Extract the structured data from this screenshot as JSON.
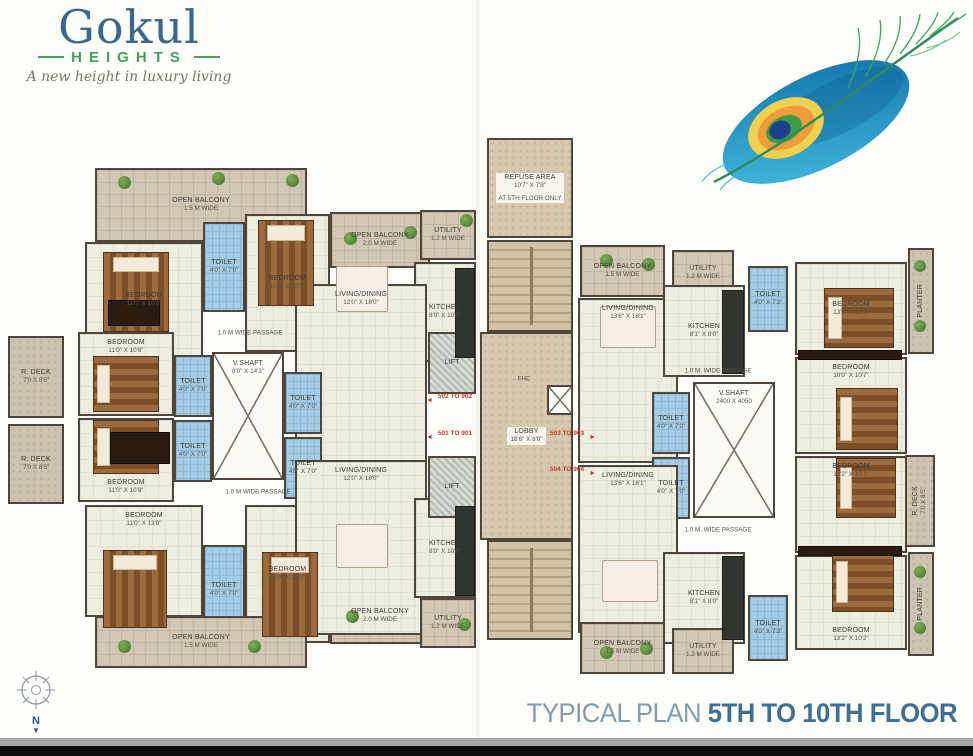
{
  "brand": {
    "name": "Gokul",
    "sub": "HEIGHTS",
    "tagline": "A new height in luxury living"
  },
  "footer": {
    "title_regular": "TYPICAL PLAN",
    "title_bold": "5TH TO 10TH FLOOR"
  },
  "compass": {
    "north": "N",
    "arrow": "▼"
  },
  "colors": {
    "brand_blue": "#39688f",
    "brand_green": "#43a05f",
    "title_light": "#7f9cb0",
    "title_dark": "#3e6f95",
    "flat_number_red": "#c23b33",
    "wall": "#4e453c",
    "floor": "#edeee0",
    "balcony": "#d2c6b4",
    "toilet_blue": "#a5cce4",
    "stair_tan": "#d3c3a6",
    "feather_blue": "#0f6da6",
    "feather_cyan": "#45bfe0",
    "feather_yellow": "#f0d14d",
    "feather_orange": "#ee9d3a",
    "feather_green": "#3f9b45",
    "feather_navy": "#1c3f8e"
  },
  "plan": {
    "rooms": [
      {
        "type": "balcony",
        "label": "OPEN BALCONY",
        "dims": "1.5 M WIDE",
        "x": 95,
        "y": 168,
        "w": 212,
        "h": 74
      },
      {
        "type": "floor",
        "label": "BEDROOM",
        "dims": "11'0\" X 10'0\"",
        "x": 85,
        "y": 242,
        "w": 118,
        "h": 116
      },
      {
        "type": "toilet",
        "label": "TOILET",
        "dims": "4'0\" X 7'0\"",
        "x": 203,
        "y": 222,
        "w": 42,
        "h": 90
      },
      {
        "type": "floor",
        "label": "BEDROOM",
        "dims": "10'0\" X 12'0\"",
        "x": 245,
        "y": 214,
        "w": 85,
        "h": 138
      },
      {
        "type": "balcony",
        "label": "OPEN BALCONY",
        "dims": "2.0 M WIDE",
        "x": 330,
        "y": 212,
        "w": 100,
        "h": 56
      },
      {
        "type": "balcony",
        "label": "UTILITY",
        "dims": "1.2 M WIDE",
        "x": 420,
        "y": 210,
        "w": 56,
        "h": 50
      },
      {
        "type": "floor",
        "label": "KITCHEN",
        "dims": "8'0\" X 10'0\"",
        "x": 414,
        "y": 262,
        "w": 62,
        "h": 100
      },
      {
        "type": "floor",
        "label": "LIVING/DINING",
        "dims": "12'0\" X 18'0\"",
        "x": 295,
        "y": 284,
        "w": 132,
        "h": 180,
        "la": "t"
      },
      {
        "type": "shaft",
        "label": "V.SHAFT",
        "dims": "8'0\" X 14'3\"",
        "x": 212,
        "y": 352,
        "w": 72,
        "h": 128,
        "la": "t"
      },
      {
        "type": "toilet",
        "label": "TOILET",
        "dims": "4'0\" X 7'0\"",
        "x": 174,
        "y": 355,
        "w": 38,
        "h": 62
      },
      {
        "type": "toilet",
        "label": "TOILET",
        "dims": "4'0\" X 7'0\"",
        "x": 174,
        "y": 420,
        "w": 38,
        "h": 62
      },
      {
        "type": "toilet",
        "label": "TOILET",
        "dims": "4'0\" X 7'0\"",
        "x": 284,
        "y": 372,
        "w": 38,
        "h": 62
      },
      {
        "type": "toilet",
        "label": "TOILET",
        "dims": "4'0\" X 7'0\"",
        "x": 284,
        "y": 437,
        "w": 38,
        "h": 62
      },
      {
        "type": "floor",
        "label": "BEDROOM",
        "dims": "11'0\" X 10'8\"",
        "x": 78,
        "y": 332,
        "w": 96,
        "h": 84,
        "la": "t"
      },
      {
        "type": "floor",
        "label": "BEDROOM",
        "dims": "11'0\" X 10'8\"",
        "x": 78,
        "y": 418,
        "w": 96,
        "h": 84,
        "la": "b"
      },
      {
        "type": "deck",
        "label": "R. DECK",
        "dims": "7'0 X 8'5\"",
        "x": 8,
        "y": 336,
        "w": 56,
        "h": 82
      },
      {
        "type": "deck",
        "label": "R. DECK",
        "dims": "7'0 X 8'5\"",
        "x": 8,
        "y": 424,
        "w": 56,
        "h": 80
      },
      {
        "type": "floor",
        "label": "BEDROOM",
        "dims": "11'0\" X 13'0\"",
        "x": 85,
        "y": 505,
        "w": 118,
        "h": 112,
        "la": "t"
      },
      {
        "type": "toilet",
        "label": "TOILET",
        "dims": "4'0\" X 7'0\"",
        "x": 203,
        "y": 545,
        "w": 42,
        "h": 90
      },
      {
        "type": "floor",
        "label": "BEDROOM",
        "dims": "10'0\" X 13'0\"",
        "x": 245,
        "y": 505,
        "w": 85,
        "h": 138
      },
      {
        "type": "balcony",
        "label": "OPEN BALCONY",
        "dims": "2.0 M WIDE",
        "x": 330,
        "y": 588,
        "w": 100,
        "h": 56
      },
      {
        "type": "floor",
        "label": "LIVING/DINING",
        "dims": "12'0\" X 18'0\"",
        "x": 295,
        "y": 460,
        "w": 132,
        "h": 175,
        "la": "t"
      },
      {
        "type": "floor",
        "label": "KITCHEN",
        "dims": "8'0\" X 10'0\"",
        "x": 414,
        "y": 498,
        "w": 62,
        "h": 100
      },
      {
        "type": "balcony",
        "label": "UTILITY",
        "dims": "1.2 M WIDE",
        "x": 420,
        "y": 598,
        "w": 56,
        "h": 50
      },
      {
        "type": "balcony",
        "label": "OPEN BALCONY",
        "dims": "1.5 M WIDE",
        "x": 95,
        "y": 616,
        "w": 212,
        "h": 52
      },
      {
        "type": "lift",
        "label": "LIFT",
        "x": 428,
        "y": 332,
        "w": 48,
        "h": 62
      },
      {
        "type": "lift",
        "label": "LIFT",
        "x": 428,
        "y": 456,
        "w": 48,
        "h": 62
      },
      {
        "type": "lobbytex",
        "label": "REFUSE AREA",
        "dims": "10'7\" X 7'8\"",
        "extra": "AT 5TH FLOOR ONLY",
        "x": 487,
        "y": 138,
        "w": 86,
        "h": 100
      },
      {
        "type": "stairs",
        "x": 487,
        "y": 240,
        "w": 86,
        "h": 92
      },
      {
        "type": "lobbytex",
        "label": "LOBBY",
        "dims": "18'6\" X 8'0\"",
        "x": 480,
        "y": 332,
        "w": 93,
        "h": 208
      },
      {
        "type": "shaft",
        "x": 547,
        "y": 385,
        "w": 26,
        "h": 30
      },
      {
        "type": "stairs",
        "x": 487,
        "y": 540,
        "w": 86,
        "h": 100
      },
      {
        "type": "balcony",
        "label": "OPEN BALCONY",
        "dims": "1.5 M WIDE",
        "x": 580,
        "y": 245,
        "w": 85,
        "h": 52
      },
      {
        "type": "balcony",
        "label": "UTILITY",
        "dims": "1.2 M WIDE",
        "x": 672,
        "y": 250,
        "w": 62,
        "h": 46
      },
      {
        "type": "toilet",
        "label": "TOILET",
        "dims": "4'0\" X 7'3\"",
        "x": 748,
        "y": 266,
        "w": 40,
        "h": 66
      },
      {
        "type": "floor",
        "label": "BEDROOM",
        "dims": "13'0\" X 10'0\"",
        "x": 795,
        "y": 262,
        "w": 112,
        "h": 93
      },
      {
        "type": "planter",
        "label": "PLANTER",
        "x": 908,
        "y": 248,
        "w": 26,
        "h": 106,
        "vertical": true
      },
      {
        "type": "floor",
        "label": "LIVING/DINING",
        "dims": "13'6\" X 18'1\"",
        "x": 578,
        "y": 298,
        "w": 100,
        "h": 165,
        "la": "t"
      },
      {
        "type": "floor",
        "label": "KITCHEN",
        "dims": "8'1\" X 8'0\"",
        "x": 663,
        "y": 285,
        "w": 82,
        "h": 92
      },
      {
        "type": "shaft",
        "label": "V.SHAFT",
        "dims": "2400 X 4050",
        "x": 693,
        "y": 382,
        "w": 82,
        "h": 136,
        "la": "t"
      },
      {
        "type": "toilet",
        "label": "TOILET",
        "dims": "4'0\" X 7'0\"",
        "x": 652,
        "y": 392,
        "w": 38,
        "h": 62
      },
      {
        "type": "toilet",
        "label": "TOILET",
        "dims": "4'0\" X 7'0\"",
        "x": 652,
        "y": 457,
        "w": 38,
        "h": 62
      },
      {
        "type": "floor",
        "label": "BEDROOM",
        "dims": "10'0\" X 10'7\"",
        "x": 795,
        "y": 357,
        "w": 112,
        "h": 97,
        "la": "t"
      },
      {
        "type": "deck",
        "label": "R. DECK",
        "dims": "7'0 X 8'5\"",
        "x": 905,
        "y": 455,
        "w": 30,
        "h": 92,
        "vertical": true
      },
      {
        "type": "floor",
        "label": "BEDROOM",
        "dims": "13'2\" X 10'1\"",
        "x": 795,
        "y": 456,
        "w": 112,
        "h": 97,
        "la": "t"
      },
      {
        "type": "floor",
        "label": "BEDROOM",
        "dims": "13'2\" X 10'2\"",
        "x": 795,
        "y": 555,
        "w": 112,
        "h": 95,
        "la": "b"
      },
      {
        "type": "planter",
        "label": "PLANTER",
        "x": 908,
        "y": 552,
        "w": 26,
        "h": 104,
        "vertical": true
      },
      {
        "type": "floor",
        "label": "LIVING/DINING",
        "dims": "13'6\" X 18'1\"",
        "x": 578,
        "y": 465,
        "w": 100,
        "h": 168,
        "la": "t"
      },
      {
        "type": "floor",
        "label": "KITCHEN",
        "dims": "8'1\" X 8'0\"",
        "x": 663,
        "y": 552,
        "w": 82,
        "h": 92
      },
      {
        "type": "toilet",
        "label": "TOILET",
        "dims": "4'0\" X 7'3\"",
        "x": 748,
        "y": 595,
        "w": 40,
        "h": 66
      },
      {
        "type": "balcony",
        "label": "UTILITY",
        "dims": "1.2 M WIDE",
        "x": 672,
        "y": 628,
        "w": 62,
        "h": 46
      },
      {
        "type": "balcony",
        "label": "OPEN BALCONY",
        "dims": "1.5 M WIDE",
        "x": 580,
        "y": 622,
        "w": 85,
        "h": 52
      }
    ],
    "passages": [
      {
        "text": "1.0 M WIDE PASSAGE",
        "x": 250,
        "y": 333
      },
      {
        "text": "1.0 M WIDE PASSAGE",
        "x": 258,
        "y": 492
      },
      {
        "text": "1.0 M. WIDE PASSAGE",
        "x": 718,
        "y": 371
      },
      {
        "text": "1.0 M. WIDE PASSAGE",
        "x": 718,
        "y": 530
      },
      {
        "text": "FHC",
        "x": 524,
        "y": 379
      }
    ],
    "flat_labels": [
      {
        "text": "502 TO 902",
        "x": 437,
        "y": 393,
        "dir": "left"
      },
      {
        "text": "501 TO 901",
        "x": 437,
        "y": 430,
        "dir": "left"
      },
      {
        "text": "503 TO 903",
        "x": 549,
        "y": 430,
        "dir": "right"
      },
      {
        "text": "504 TO 904",
        "x": 549,
        "y": 466,
        "dir": "right"
      }
    ],
    "furniture": [
      {
        "kind": "bed-v",
        "x": 103,
        "y": 252,
        "w": 66,
        "h": 80
      },
      {
        "kind": "bed-v",
        "x": 258,
        "y": 220,
        "w": 56,
        "h": 86
      },
      {
        "kind": "bed-h",
        "x": 93,
        "y": 356,
        "w": 66,
        "h": 56
      },
      {
        "kind": "bed-h",
        "x": 93,
        "y": 420,
        "w": 66,
        "h": 54
      },
      {
        "kind": "bed-v",
        "x": 103,
        "y": 550,
        "w": 64,
        "h": 78
      },
      {
        "kind": "bed-v",
        "x": 262,
        "y": 552,
        "w": 56,
        "h": 85
      },
      {
        "kind": "bed-h",
        "x": 824,
        "y": 288,
        "w": 70,
        "h": 60
      },
      {
        "kind": "bed-h",
        "x": 836,
        "y": 388,
        "w": 62,
        "h": 62
      },
      {
        "kind": "bed-h",
        "x": 836,
        "y": 458,
        "w": 60,
        "h": 60
      },
      {
        "kind": "bed-h",
        "x": 832,
        "y": 552,
        "w": 62,
        "h": 60
      },
      {
        "kind": "table",
        "x": 336,
        "y": 266,
        "w": 52,
        "h": 46
      },
      {
        "kind": "table",
        "x": 336,
        "y": 524,
        "w": 52,
        "h": 44
      },
      {
        "kind": "table",
        "x": 600,
        "y": 306,
        "w": 56,
        "h": 42
      },
      {
        "kind": "table",
        "x": 602,
        "y": 560,
        "w": 56,
        "h": 42
      },
      {
        "kind": "counter",
        "x": 455,
        "y": 268,
        "w": 20,
        "h": 90
      },
      {
        "kind": "counter",
        "x": 455,
        "y": 506,
        "w": 20,
        "h": 90
      },
      {
        "kind": "counter",
        "x": 722,
        "y": 290,
        "w": 22,
        "h": 84
      },
      {
        "kind": "counter",
        "x": 722,
        "y": 556,
        "w": 22,
        "h": 84
      },
      {
        "kind": "wardrobe",
        "x": 108,
        "y": 300,
        "w": 52,
        "h": 26
      },
      {
        "kind": "wardrobe",
        "x": 110,
        "y": 432,
        "w": 60,
        "h": 32
      },
      {
        "kind": "wardrobe",
        "x": 798,
        "y": 350,
        "w": 104,
        "h": 10
      },
      {
        "kind": "wardrobe",
        "x": 798,
        "y": 546,
        "w": 104,
        "h": 10
      },
      {
        "kind": "plant",
        "x": 118,
        "y": 176,
        "w": 13,
        "h": 13
      },
      {
        "kind": "plant",
        "x": 212,
        "y": 172,
        "w": 13,
        "h": 13
      },
      {
        "kind": "plant",
        "x": 286,
        "y": 174,
        "w": 13,
        "h": 13
      },
      {
        "kind": "plant",
        "x": 344,
        "y": 232,
        "w": 13,
        "h": 13
      },
      {
        "kind": "plant",
        "x": 404,
        "y": 226,
        "w": 13,
        "h": 13
      },
      {
        "kind": "plant",
        "x": 460,
        "y": 214,
        "w": 13,
        "h": 13
      },
      {
        "kind": "plant",
        "x": 118,
        "y": 640,
        "w": 13,
        "h": 13
      },
      {
        "kind": "plant",
        "x": 248,
        "y": 640,
        "w": 13,
        "h": 13
      },
      {
        "kind": "plant",
        "x": 346,
        "y": 610,
        "w": 13,
        "h": 13
      },
      {
        "kind": "plant",
        "x": 458,
        "y": 618,
        "w": 13,
        "h": 13
      },
      {
        "kind": "plant",
        "x": 600,
        "y": 254,
        "w": 13,
        "h": 13
      },
      {
        "kind": "plant",
        "x": 642,
        "y": 258,
        "w": 13,
        "h": 13
      },
      {
        "kind": "plant",
        "x": 600,
        "y": 646,
        "w": 13,
        "h": 13
      },
      {
        "kind": "plant",
        "x": 640,
        "y": 642,
        "w": 13,
        "h": 13
      },
      {
        "kind": "plant",
        "x": 914,
        "y": 260,
        "w": 12,
        "h": 12
      },
      {
        "kind": "plant",
        "x": 914,
        "y": 320,
        "w": 12,
        "h": 12
      },
      {
        "kind": "plant",
        "x": 914,
        "y": 566,
        "w": 12,
        "h": 12
      },
      {
        "kind": "plant",
        "x": 914,
        "y": 622,
        "w": 12,
        "h": 12
      }
    ]
  }
}
